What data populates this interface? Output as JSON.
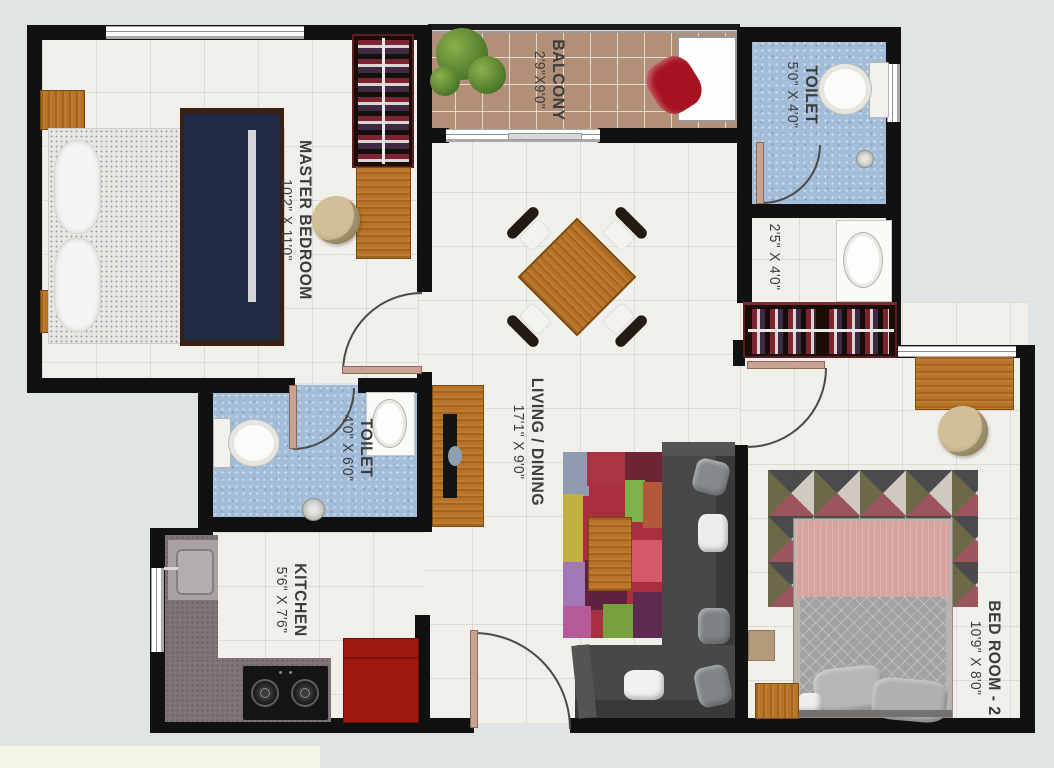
{
  "rooms": {
    "master_bedroom": {
      "name": "MASTER BEDROOM",
      "dims": "10'2\" X 11'0\""
    },
    "balcony": {
      "name": "BALCONY",
      "dims": "2'9\"X9'0\""
    },
    "toilet_top": {
      "name": "TOILET",
      "dims": "5'0\" X 4'0\""
    },
    "passage": {
      "dims": "2'5\" X 4'0\""
    },
    "living_dining": {
      "name": "LIVING / DINING",
      "dims": "17'1\" X 9'0\""
    },
    "toilet_left": {
      "name": "TOILET",
      "dims": "4'0\" X 6'0\""
    },
    "kitchen": {
      "name": "KITCHEN",
      "dims": "5'6\" X 7'6\""
    },
    "bedroom_2": {
      "name": "BED ROOM - 2",
      "dims": "10'9\" X 8'0\""
    }
  },
  "theme": {
    "background": "#e0e4e5",
    "wall": "#111111",
    "floor": "#f1efe9",
    "balcony-floor": "#b29078",
    "toilet-floor": "#a3bdd8",
    "wood": "#b97326",
    "counter": "#7f747a",
    "fridge": "#9e1a10",
    "sofa": "#484848",
    "bed2-blanket": "#d7a3a0",
    "label-text": "#3c3c3c",
    "legend-strip": "#f5f7e9",
    "door-leaf": "#c9a291"
  }
}
